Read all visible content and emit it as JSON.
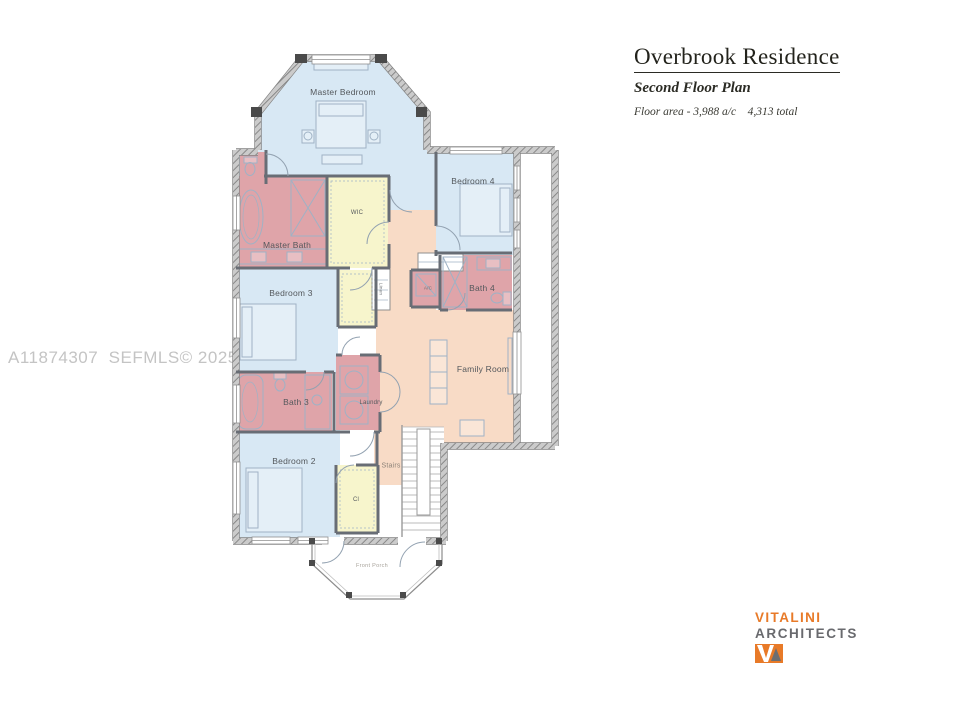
{
  "header": {
    "title": "Overbrook Residence",
    "subtitle": "Second Floor Plan",
    "area_note": "Floor area - 3,988 a/c    4,313 total"
  },
  "watermark": "A11874307  SEFMLS© 2025",
  "rooms": {
    "master_bedroom": "Master Bedroom",
    "bedroom_4": "Bedroom 4",
    "wic": "WIC",
    "master_bath": "Master Bath",
    "bedroom_3": "Bedroom 3",
    "linen": "Linen",
    "ac": "A/C",
    "bath_4": "Bath 4",
    "bath_3": "Bath 3",
    "laundry": "Laundry",
    "family_room": "Family Room",
    "bedroom_2": "Bedroom 2",
    "stairs": "Stairs",
    "closet": "Cl",
    "front_porch": "Front Porch"
  },
  "branding": {
    "name": "VITALINI",
    "type": "ARCHITECTS"
  },
  "colors": {
    "bedroom_fill": "#d8e8f4",
    "bath_fill": "#dfa4a9",
    "closet_fill": "#f7f5cc",
    "common_fill": "#f8dbc6",
    "wall_gray": "#808080",
    "accent_orange": "#e87a28",
    "logo_gray": "#696a6e",
    "watermark_gray": "#c4c4c4"
  }
}
